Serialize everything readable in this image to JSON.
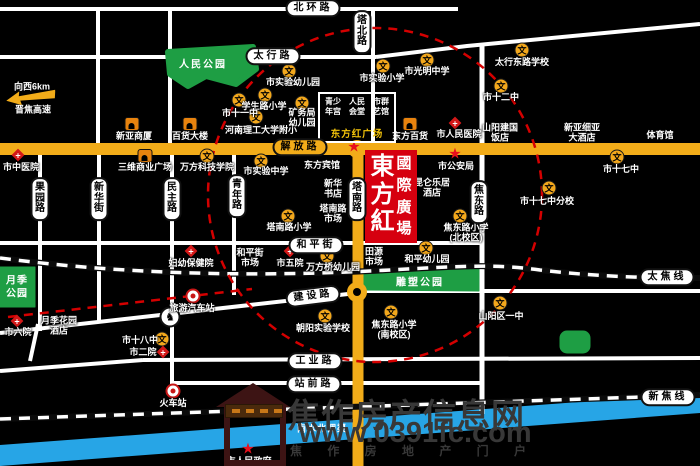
{
  "map": {
    "colors": {
      "road_major": "#F2AC19",
      "park": "#1E9E44",
      "river": "#27A5E6",
      "landmark": "#D6000F",
      "dash": "#D40000"
    },
    "glyphs": {
      "school": "文",
      "star": "★",
      "horse": "♞"
    },
    "title": {
      "line1": "東方紅",
      "line2": "國際廣場"
    },
    "plaza_box": {
      "cols": [
        [
          "青少",
          "年宫"
        ],
        [
          "人民",
          "会堂"
        ],
        [
          "市群",
          "艺馆"
        ]
      ],
      "caption": "东方红广场"
    },
    "direction": {
      "to": "向西6km",
      "highway": "晋焦高速"
    },
    "road_labels": [
      {
        "label": "北环路",
        "x": 313,
        "y": 8
      },
      {
        "label": "太行路",
        "x": 273,
        "y": 56
      },
      {
        "label": "解放路",
        "x": 300,
        "y": 147,
        "yellow": true
      },
      {
        "label": "和平街",
        "x": 316,
        "y": 245
      },
      {
        "label": "建设路",
        "x": 313,
        "y": 296,
        "rot": true
      },
      {
        "label": "工业路",
        "x": 315,
        "y": 361
      },
      {
        "label": "站前路",
        "x": 314,
        "y": 384
      },
      {
        "label": "果园路",
        "x": 40,
        "y": 199,
        "v": true
      },
      {
        "label": "新华街",
        "x": 99,
        "y": 199,
        "v": true
      },
      {
        "label": "民主路",
        "x": 172,
        "y": 199,
        "v": true
      },
      {
        "label": "青年路",
        "x": 237,
        "y": 196,
        "v": true
      },
      {
        "label": "塔北路",
        "x": 362,
        "y": 32,
        "v": true
      },
      {
        "label": "塔南路",
        "x": 357,
        "y": 199,
        "v": true
      },
      {
        "label": "焦东路",
        "x": 479,
        "y": 202,
        "v": true
      },
      {
        "label": "太焦线",
        "x": 667,
        "y": 277
      },
      {
        "label": "新焦线",
        "x": 668,
        "y": 397
      }
    ],
    "parks": [
      {
        "label": "人民公园"
      },
      {
        "lines": [
          "月季",
          "公园"
        ]
      },
      {
        "label": "雕塑公园"
      },
      {
        "label": ""
      }
    ],
    "river": {
      "label": "南水北调渠"
    },
    "pois": [
      {
        "t": "school",
        "label": "市实验幼儿园",
        "ix": 289,
        "iy": 71,
        "lx": 293,
        "ly": 82
      },
      {
        "t": "school",
        "label": "学生路小学",
        "ix": 265,
        "iy": 95,
        "lx": 264,
        "ly": 106
      },
      {
        "t": "school",
        "label": "市十一中",
        "ix": 239,
        "iy": 100,
        "lx": 240,
        "ly": 113
      },
      {
        "t": "school",
        "label": "河南理工大学附小",
        "ix": 256,
        "iy": 117,
        "lx": 261,
        "ly": 130
      },
      {
        "t": "school",
        "lines": [
          "矿务局",
          "幼儿园"
        ],
        "ix": 302,
        "iy": 103,
        "lx": 302,
        "ly": 118
      },
      {
        "t": "school",
        "label": "市实验小学",
        "ix": 383,
        "iy": 66,
        "lx": 382,
        "ly": 78
      },
      {
        "t": "school",
        "label": "市光明中学",
        "ix": 427,
        "iy": 60,
        "lx": 427,
        "ly": 71
      },
      {
        "t": "school",
        "label": "太行东路学校",
        "ix": 522,
        "iy": 50,
        "lx": 522,
        "ly": 62
      },
      {
        "t": "school",
        "label": "市十二中",
        "ix": 501,
        "iy": 86,
        "lx": 501,
        "ly": 97
      },
      {
        "t": "school",
        "label": "万方科技学院",
        "ix": 207,
        "iy": 156,
        "lx": 207,
        "ly": 167
      },
      {
        "t": "school",
        "label": "市实验中学",
        "ix": 261,
        "iy": 161,
        "lx": 266,
        "ly": 171
      },
      {
        "t": "school",
        "label": "塔南路小学",
        "ix": 288,
        "iy": 216,
        "lx": 289,
        "ly": 227
      },
      {
        "t": "school",
        "label": "万方桥幼儿园",
        "ix": 327,
        "iy": 256,
        "lx": 333,
        "ly": 267
      },
      {
        "t": "school",
        "label": "朝阳实验学校",
        "ix": 325,
        "iy": 316,
        "lx": 323,
        "ly": 328
      },
      {
        "t": "school",
        "lines": [
          "焦东路小学",
          "(南校区)"
        ],
        "ix": 391,
        "iy": 312,
        "lx": 394,
        "ly": 330
      },
      {
        "t": "school",
        "lines": [
          "焦东路小学",
          "(北校区)"
        ],
        "ix": 460,
        "iy": 216,
        "lx": 466,
        "ly": 233
      },
      {
        "t": "school",
        "label": "和平幼儿园",
        "ix": 426,
        "iy": 248,
        "lx": 427,
        "ly": 259
      },
      {
        "t": "school",
        "label": "市十七中",
        "ix": 617,
        "iy": 157,
        "lx": 621,
        "ly": 169
      },
      {
        "t": "school",
        "label": "市十七中分校",
        "ix": 549,
        "iy": 188,
        "lx": 547,
        "ly": 201
      },
      {
        "t": "school",
        "label": "山阳区一中",
        "ix": 500,
        "iy": 303,
        "lx": 501,
        "ly": 316
      },
      {
        "t": "school",
        "label": "市十八中",
        "ix": 162,
        "iy": 339,
        "lx": 140,
        "ly": 340
      },
      {
        "t": "hospital",
        "label": "市中医院",
        "ix": 18,
        "iy": 155,
        "lx": 21,
        "ly": 167
      },
      {
        "t": "hospital",
        "label": "市人民医院",
        "ix": 455,
        "iy": 123,
        "lx": 459,
        "ly": 134
      },
      {
        "t": "hospital",
        "label": "妇幼保健院",
        "ix": 191,
        "iy": 251,
        "lx": 191,
        "ly": 263
      },
      {
        "t": "hospital",
        "label": "市五院",
        "ix": 290,
        "iy": 251,
        "lx": 290,
        "ly": 263
      },
      {
        "t": "hospital",
        "label": "市六院",
        "ix": 17,
        "iy": 321,
        "lx": 18,
        "ly": 332
      },
      {
        "t": "hospital",
        "label": "市二院",
        "ix": 163,
        "iy": 352,
        "lx": 143,
        "ly": 352
      },
      {
        "t": "shop",
        "label": "新亚商厦",
        "ix": 132,
        "iy": 124,
        "lx": 134,
        "ly": 136
      },
      {
        "t": "shop",
        "label": "百货大楼",
        "ix": 190,
        "iy": 124,
        "lx": 190,
        "ly": 136
      },
      {
        "t": "shop",
        "label": "东方百货",
        "ix": 410,
        "iy": 124,
        "lx": 410,
        "ly": 136
      },
      {
        "t": "shop",
        "label": "三维商业广场",
        "ix": 145,
        "iy": 156,
        "lx": 145,
        "ly": 167
      },
      {
        "t": "star",
        "label": "市公安局",
        "ix": 455,
        "iy": 154,
        "lx": 456,
        "ly": 166
      },
      {
        "t": "star",
        "label": "市人民政府",
        "ix": 248,
        "iy": 449,
        "lx": 249,
        "ly": 461
      },
      {
        "t": "star",
        "ix": 354,
        "iy": 147
      },
      {
        "t": "ring",
        "label": "火车站",
        "ix": 173,
        "iy": 391,
        "lx": 173,
        "ly": 403
      },
      {
        "t": "ring",
        "label": "旅游汽车站",
        "ix": 193,
        "iy": 296,
        "lx": 192,
        "ly": 308
      },
      {
        "t": "horse",
        "ix": 170,
        "iy": 317
      },
      {
        "t": "text",
        "label": "东方宾馆",
        "lx": 322,
        "ly": 165
      },
      {
        "t": "text",
        "lines": [
          "新华",
          "书店"
        ],
        "lx": 333,
        "ly": 189
      },
      {
        "t": "text",
        "lines": [
          "塔南路",
          "市场"
        ],
        "lx": 333,
        "ly": 214
      },
      {
        "t": "text",
        "lines": [
          "昆仑乐居",
          "酒店"
        ],
        "lx": 432,
        "ly": 188
      },
      {
        "t": "text",
        "lines": [
          "山阳建国",
          "饭店"
        ],
        "lx": 500,
        "ly": 133
      },
      {
        "t": "text",
        "lines": [
          "新亚细亚",
          "大酒店"
        ],
        "lx": 582,
        "ly": 133
      },
      {
        "t": "text",
        "label": "体育馆",
        "lx": 660,
        "ly": 135
      },
      {
        "t": "text",
        "lines": [
          "和平街",
          "市场"
        ],
        "lx": 250,
        "ly": 258
      },
      {
        "t": "text",
        "lines": [
          "田源",
          "市场"
        ],
        "lx": 374,
        "ly": 257
      },
      {
        "t": "text",
        "lines": [
          "月季花园",
          "酒店"
        ],
        "lx": 59,
        "ly": 326
      }
    ],
    "watermark": {
      "line1": "焦作房产信息网",
      "line2": "www.0391fc.com",
      "line3": "焦 作 房 地 产 门 户"
    }
  }
}
